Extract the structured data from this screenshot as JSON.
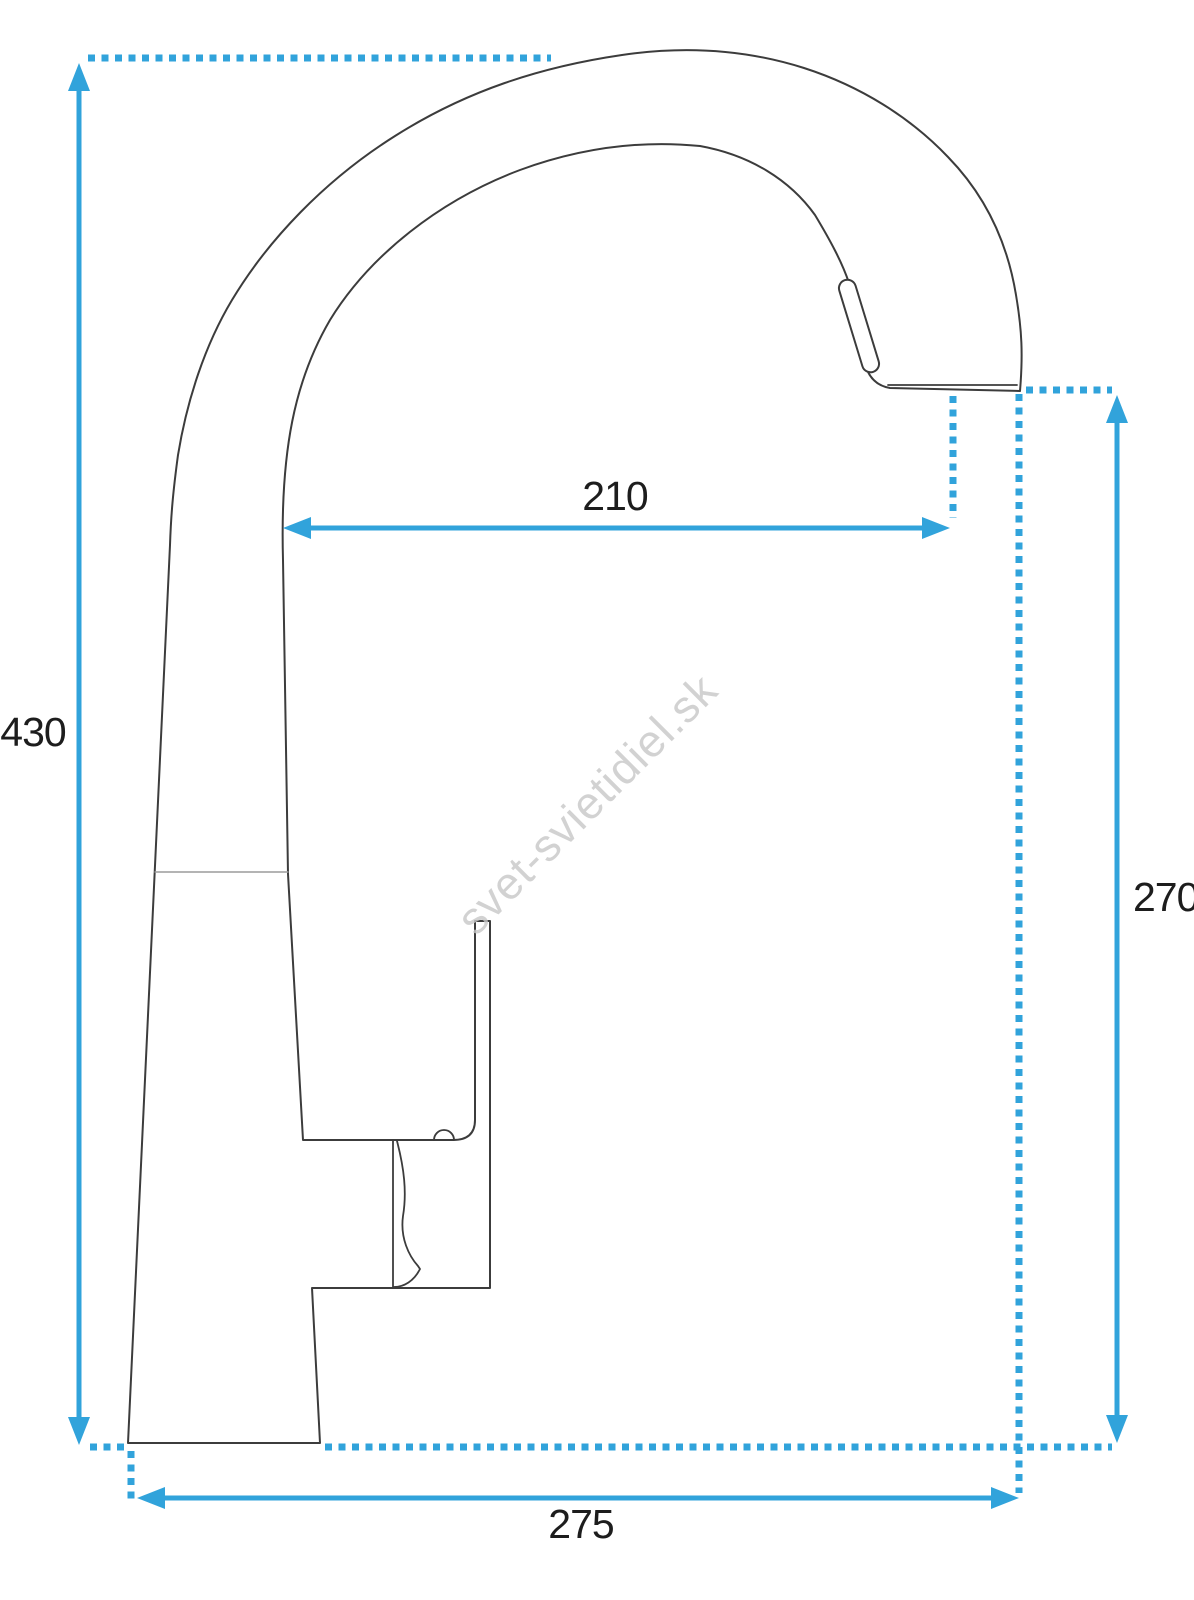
{
  "page": {
    "background_color": "#ffffff",
    "kind": "product dimension drawing"
  },
  "watermark": {
    "text": "svet-svietidiel.sk",
    "color": "#c8c8c8"
  },
  "drawing": {
    "subject": "kitchen faucet side view with dimension lines",
    "outline_color": "#3c3c3c",
    "dimension_color": "#31a3db",
    "dimensions": {
      "overall_height": {
        "value": "430",
        "orientation": "vertical",
        "position": "left"
      },
      "spout_reach": {
        "value": "210",
        "orientation": "horizontal",
        "position": "center"
      },
      "spout_height": {
        "value": "270",
        "orientation": "vertical",
        "position": "right"
      },
      "overall_depth": {
        "value": "275",
        "orientation": "horizontal",
        "position": "bottom"
      }
    }
  }
}
